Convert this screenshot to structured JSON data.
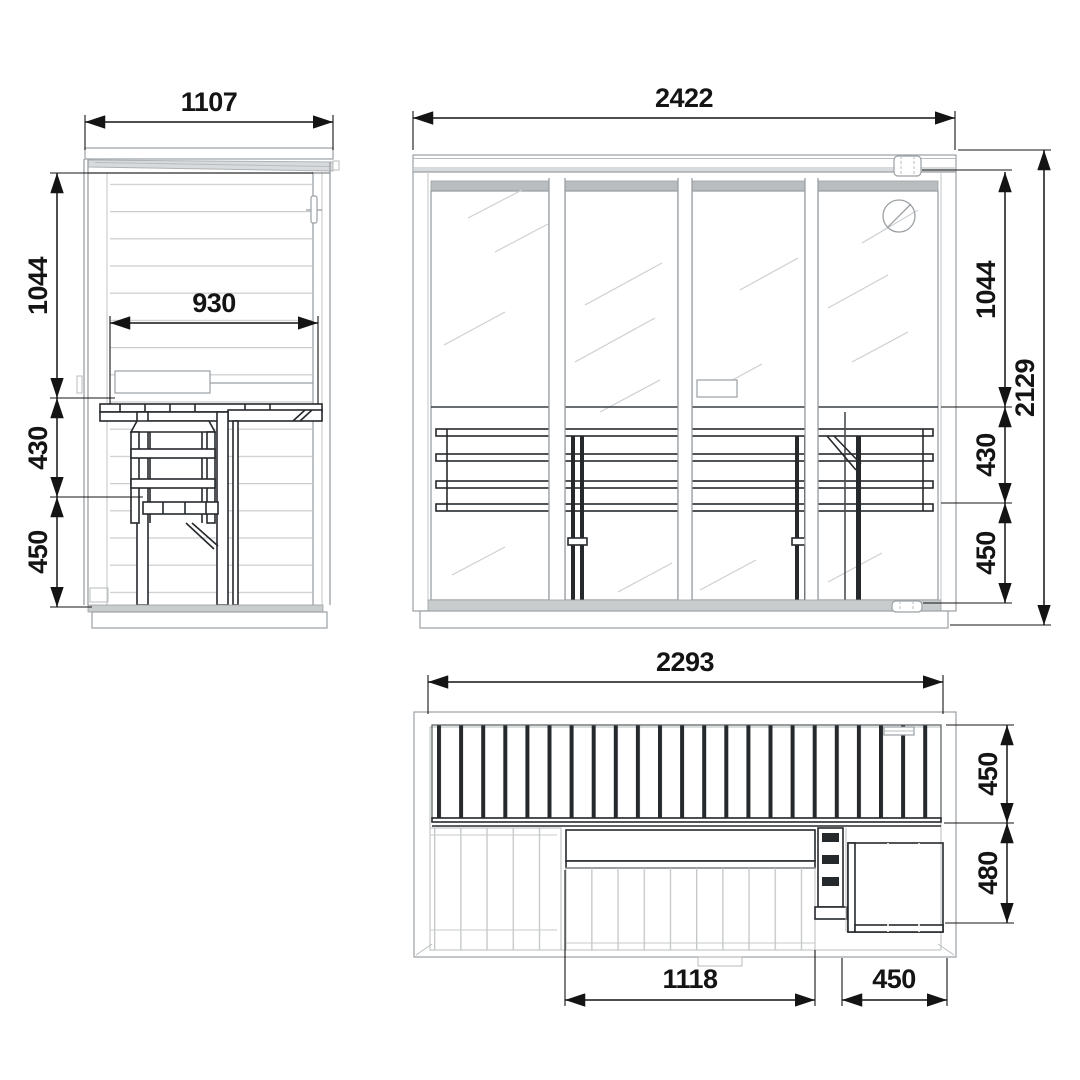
{
  "title": "sauna-three-view-dimension-drawing",
  "colors": {
    "dimension_black": "#141414",
    "detail_dark": "#26292c",
    "drawing_gray": "#9ba0a3",
    "cladding_gray": "#c6c9cb"
  },
  "dimensions": {
    "side_view": {
      "roof_width": "1107",
      "bench_length": "930",
      "wall_height": "1044",
      "bench_spacing": "430",
      "lower_bench_height": "450"
    },
    "front_view": {
      "total_width": "2422",
      "upper_height": "1044",
      "mid_height": "430",
      "lower_height": "450",
      "total_height": "2129"
    },
    "top_view": {
      "bench_length": "2293",
      "upper_bench_depth": "450",
      "side_bench_depth": "480",
      "lower_bench_length": "1118",
      "side_bench_width": "450"
    }
  }
}
